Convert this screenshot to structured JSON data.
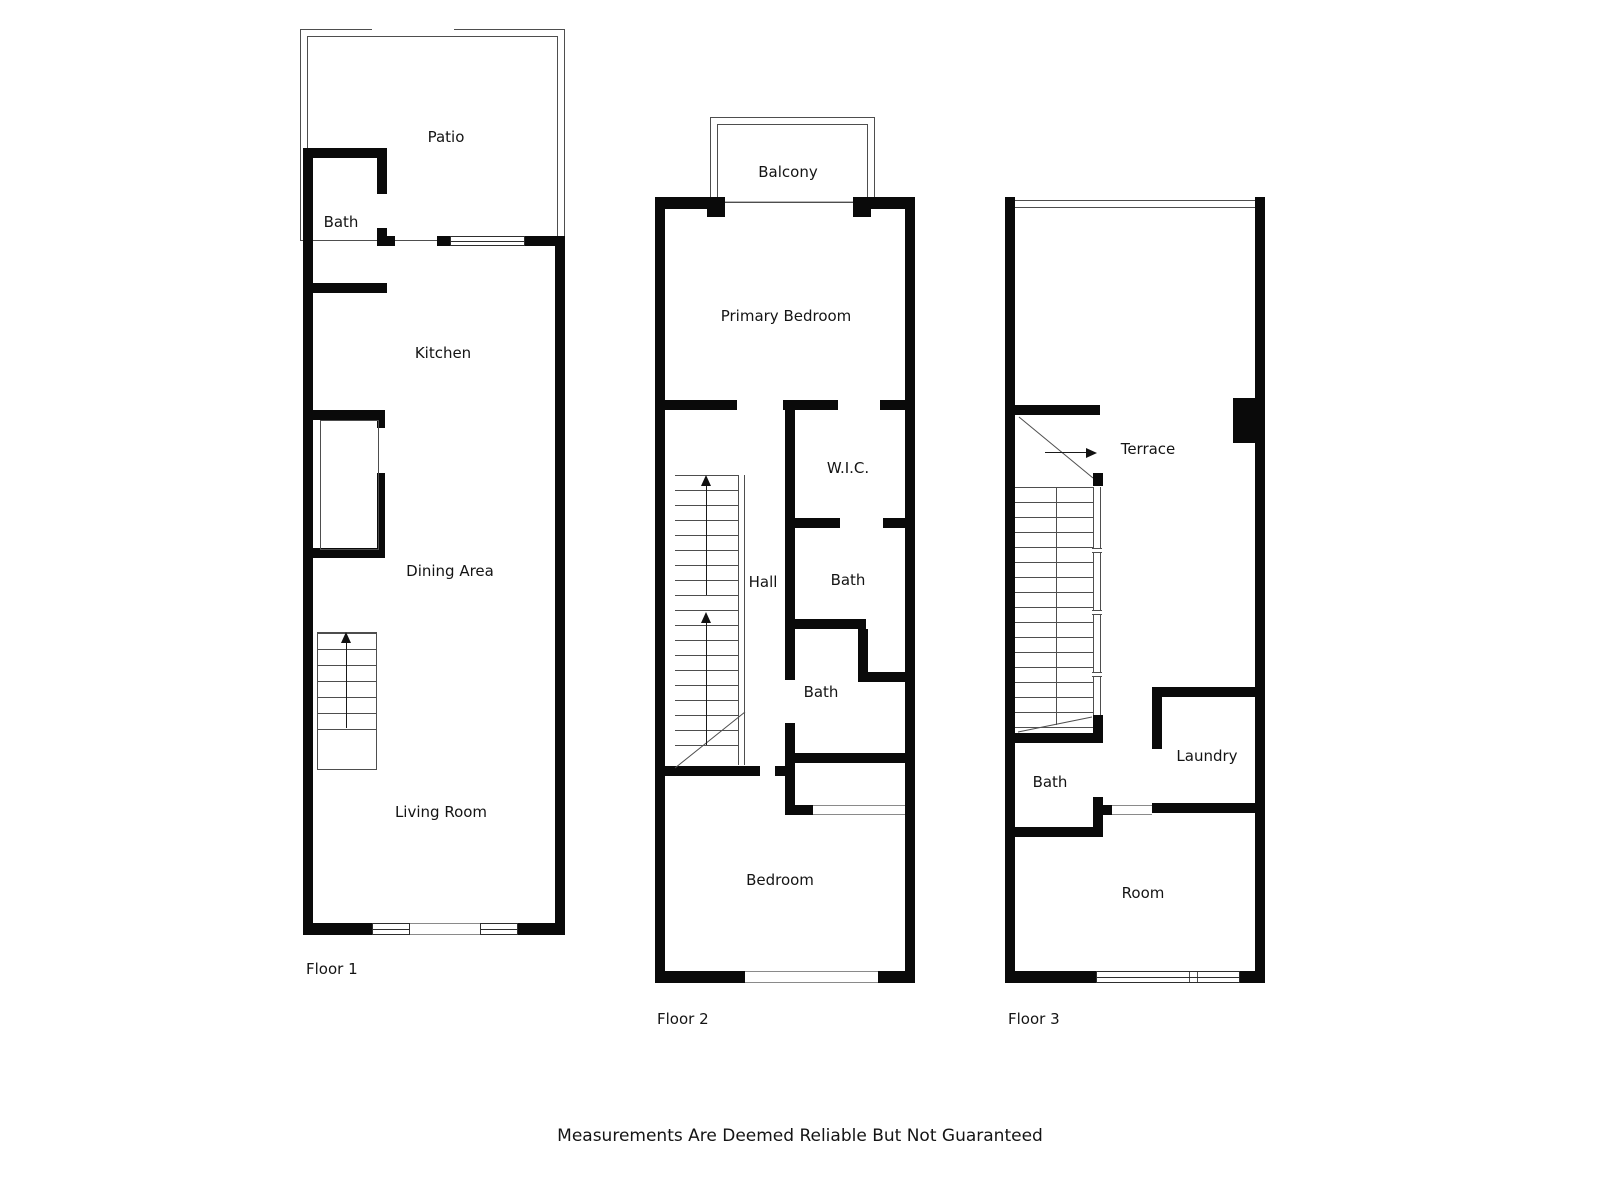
{
  "floors": [
    {
      "label": "Floor 1",
      "rooms": {
        "patio": "Patio",
        "bath": "Bath",
        "kitchen": "Kitchen",
        "dining": "Dining Area",
        "living": "Living Room"
      }
    },
    {
      "label": "Floor 2",
      "rooms": {
        "balcony": "Balcony",
        "primary_bedroom": "Primary Bedroom",
        "wic": "W.I.C.",
        "hall": "Hall",
        "bath_upper": "Bath",
        "bath_lower": "Bath",
        "bedroom": "Bedroom"
      }
    },
    {
      "label": "Floor 3",
      "rooms": {
        "terrace": "Terrace",
        "bath": "Bath",
        "laundry": "Laundry",
        "room": "Room"
      }
    }
  ],
  "footer": {
    "disclaimer": "Measurements Are Deemed Reliable But Not Guaranteed"
  },
  "colors": {
    "wall": "#0a0a0a",
    "thin_line": "#4e4e4e",
    "background": "#ffffff",
    "text": "#141414"
  }
}
